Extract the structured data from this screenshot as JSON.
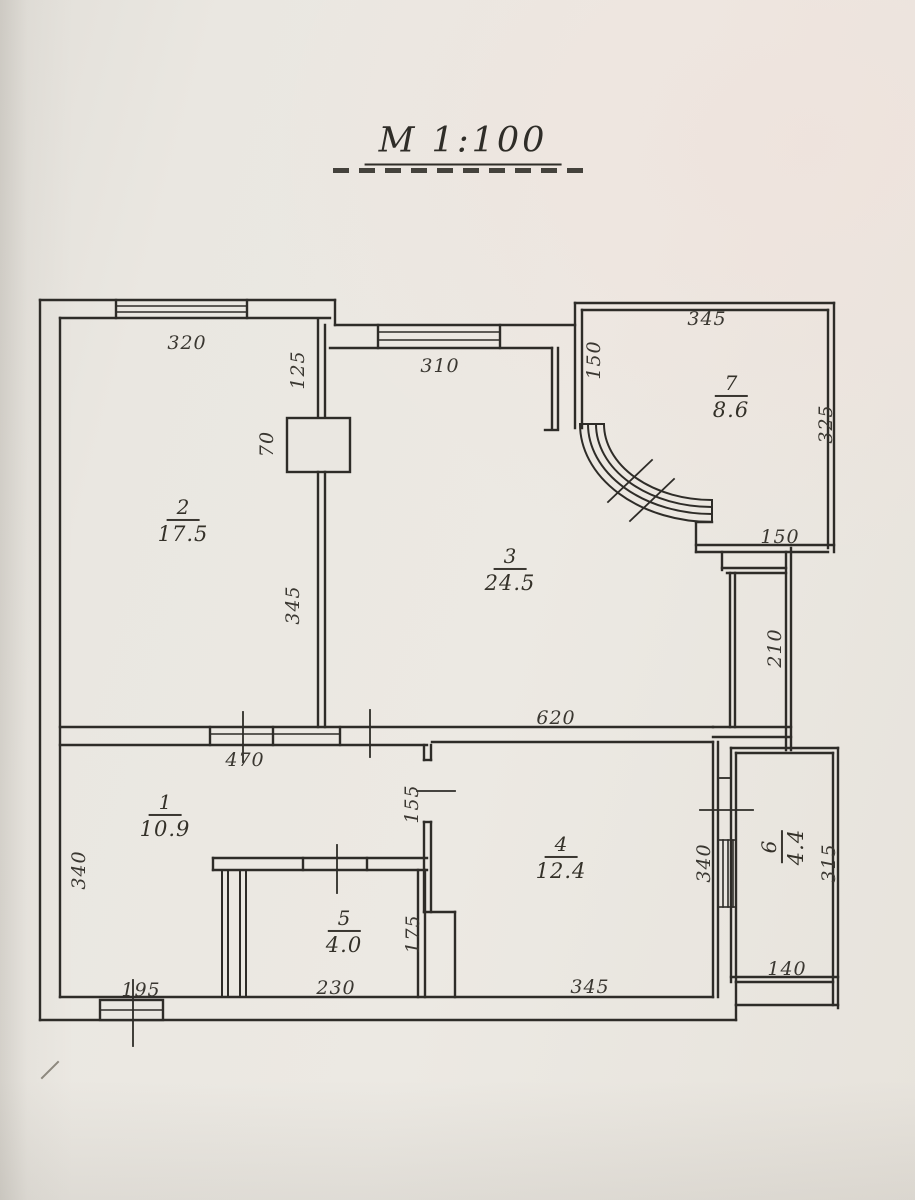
{
  "page": {
    "paper_color": "#eae7e1",
    "ink_color": "#2e2c28",
    "scale_label": "M 1:100"
  },
  "plan": {
    "rooms": [
      {
        "number": "1",
        "area": "10.9"
      },
      {
        "number": "2",
        "area": "17.5"
      },
      {
        "number": "3",
        "area": "24.5"
      },
      {
        "number": "4",
        "area": "12.4"
      },
      {
        "number": "5",
        "area": "4.0"
      },
      {
        "number": "6",
        "area": "4.4"
      },
      {
        "number": "7",
        "area": "8.6"
      }
    ],
    "dimensions": {
      "room2_top": "320",
      "room3_top": "310",
      "wall23_upper": "125",
      "wall23_pillar": "70",
      "wall23_lower": "345",
      "room7_left": "150",
      "room7_top": "345",
      "room7_right": "325",
      "room7_bottom": "150",
      "right_wall": "210",
      "room3_bottom": "620",
      "room1_top": "470",
      "room14_door": "155",
      "room1_left": "340",
      "room4_right": "340",
      "room6_right": "315",
      "room5_right": "175",
      "room1_bottom": "195",
      "room5_bottom": "230",
      "room4_bottom": "345",
      "room6_bottom": "140"
    }
  }
}
